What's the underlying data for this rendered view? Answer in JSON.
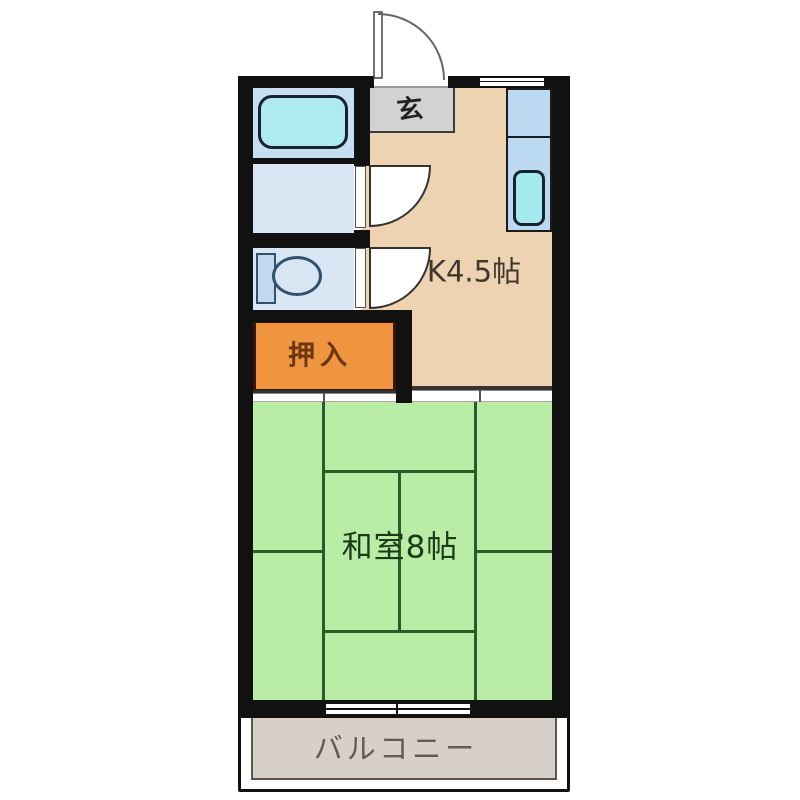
{
  "floorplan": {
    "title": "1K apartment floor plan",
    "rooms": {
      "genkan": {
        "label": "玄"
      },
      "kitchen": {
        "label": "K4.5帖"
      },
      "closet": {
        "label": "押入"
      },
      "japanese_room": {
        "label": "和室8帖"
      },
      "balcony": {
        "label": "バルコニー"
      }
    },
    "fixtures": [
      "bathtub",
      "kitchen-sink",
      "kitchen-counter",
      "toilet",
      "entrance-door",
      "washroom-door",
      "toilet-door",
      "top-window",
      "balcony-window",
      "sliding-doors"
    ],
    "colors": {
      "wall": "#111111",
      "kitchen": "#eed3b3",
      "genkan": "#d2d2d2",
      "bathroom": "#c7ddf1",
      "washroom": "#d9e7f5",
      "bathtub": "#aeeaf2",
      "counter": "#bcd9f2",
      "sink": "#a5e9f0",
      "closet": "#f0953f",
      "closet_text": "#6b3413",
      "tatami": "#b9eca4",
      "tatami_line": "#2a5c2a",
      "tatami_text": "#1a3a1a",
      "kitchen_text": "#3f372e",
      "balcony": "#d7d0c8",
      "balcony_text": "#5f5b55"
    }
  }
}
